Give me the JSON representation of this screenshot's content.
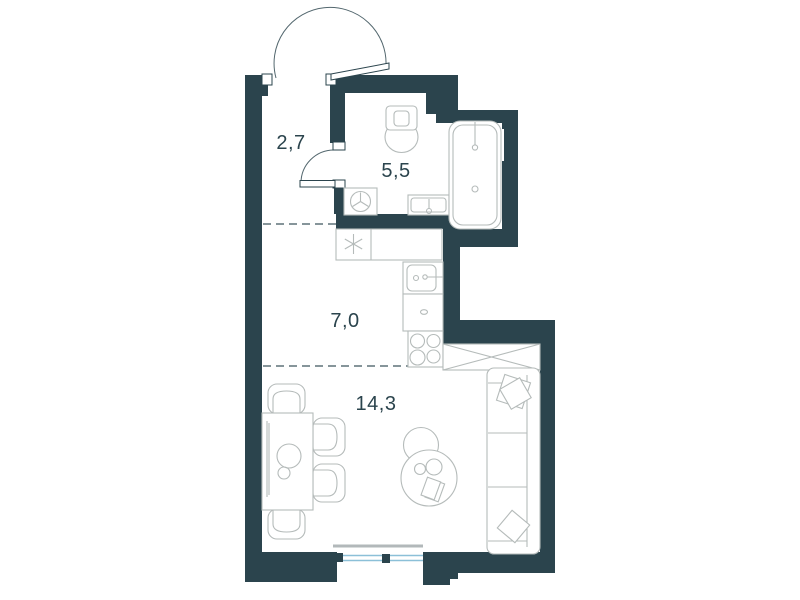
{
  "floorplan": {
    "rooms": [
      {
        "name": "hallway",
        "area_label": "2,7"
      },
      {
        "name": "bathroom",
        "area_label": "5,5"
      },
      {
        "name": "kitchen",
        "area_label": "7,0"
      },
      {
        "name": "living-room",
        "area_label": "14,3"
      }
    ],
    "colors": {
      "wall": "#2b444d",
      "furniture_line": "#b5bbba",
      "door_line": "#53676e",
      "dashed_line": "#5e7279",
      "window_glass": "#8cc0d8",
      "window_sill": "#b2b8ba",
      "label_text": "#2b444d",
      "background": "#ffffff"
    },
    "fixtures": [
      "entrance-door",
      "bathroom-door",
      "toilet",
      "washing-machine",
      "bathroom-sink",
      "bathtub",
      "refrigerator",
      "kitchen-counter",
      "kitchen-sink",
      "kitchen-cabinet",
      "stove",
      "wardrobe",
      "sofa",
      "pillows",
      "dining-table",
      "chairs",
      "coffee-tables",
      "window"
    ]
  }
}
